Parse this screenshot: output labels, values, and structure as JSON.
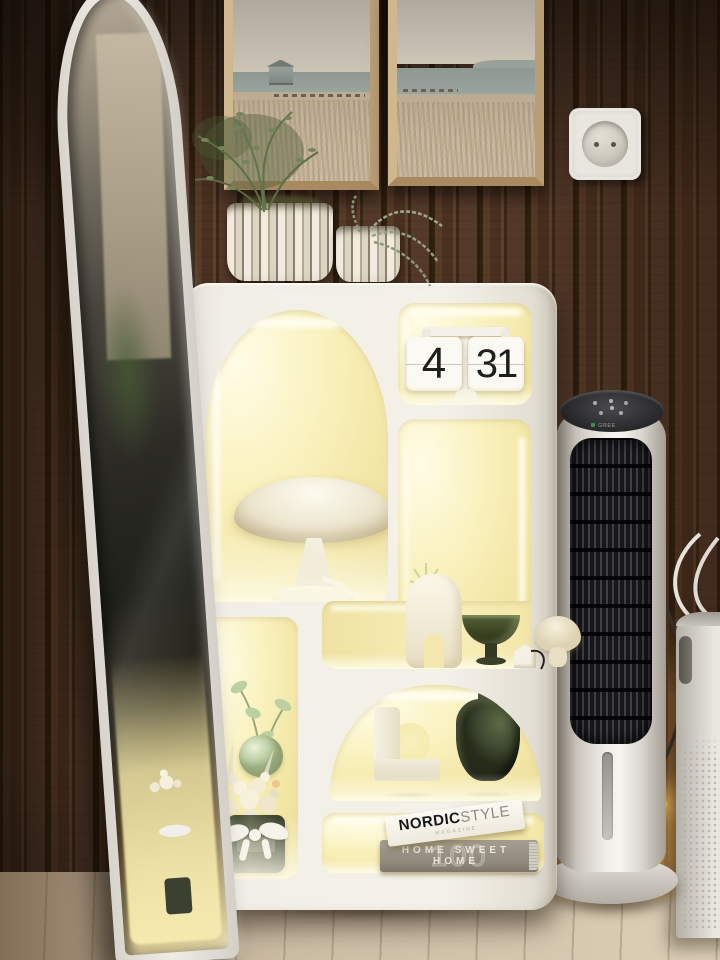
{
  "scene": {
    "label": "Cozy interior corner: LED-lit white display shelf, arched floor mirror, tower air cooler, wood slat wall",
    "colors": {
      "wall": "#4a3322",
      "floor": "#cfc1a9",
      "shelf": "#f2efe7",
      "niche_glow": "#f7efb9",
      "led_warm": "#ffd97a",
      "olive_green": "#3e4830",
      "fan_grille": "#17171a",
      "frame_wood": "#c9b28d"
    }
  },
  "clock": {
    "hours": "4",
    "minutes": "31"
  },
  "books": {
    "top": {
      "word1": "NORDIC",
      "word2": "STYLE",
      "subtitle": "MAGAZINE"
    },
    "bottom": {
      "text": "HOME SWEET HOME",
      "number": "100"
    }
  },
  "fan": {
    "brand": "GREE"
  },
  "items": {
    "wall_art_left": "seascape-painting-beach-hut-and-pier",
    "wall_art_right": "seascape-painting-dunes-and-headland",
    "outlet": "schuko-wall-socket",
    "mirror": "white-arched-floor-mirror",
    "lamp": "white-mushroom-table-lamp",
    "flip_clock": "white-flip-clock-on-pedestal",
    "planter_large": "ribbed-white-planter-with-fern",
    "planter_small": "ribbed-white-planter-with-trailing-succulent",
    "mushroom_decor": "ceramic-mushroom-ornament",
    "organic_vase": "white-organic-vase-with-succulent",
    "pedestal_bowl": "dark-green-pedestal-bowl",
    "mini_house": "white-mini-house-ornament",
    "curved_vase": "white-curved-tube-vase",
    "round_vase": "olive-green-round-vase",
    "apple_vase": "green-apple-bud-vase-with-leaves",
    "flower_pot": "cream-flower-arrangement-in-pot-with-ribbon",
    "tower_fan": "white-tower-air-cooler",
    "air_purifier": "white-air-purifier",
    "led_strip": "warm-led-strip-on-floor"
  }
}
